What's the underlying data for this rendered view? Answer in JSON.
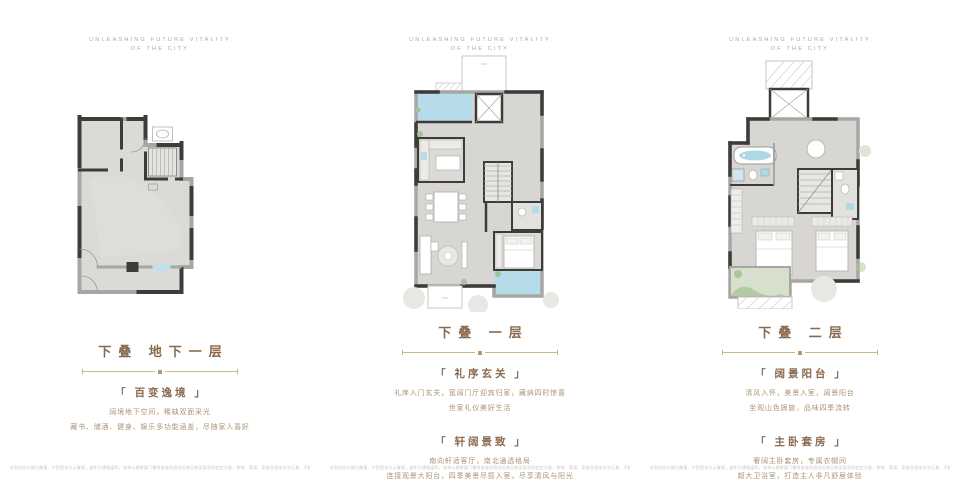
{
  "page": {
    "header_line1": "UNLEASHING FUTURE VITALITY",
    "header_line2": "OF THE CITY",
    "disclaimer": "本资料仅为要约邀请，户型图仅为示意图，面积为建筑面积，具体以政府部门最终批准的图纸及商品房买卖合同约定为准；装修、家具、家电及绿化仅为示意，不属于交付标准。"
  },
  "colors": {
    "accent_brown": "#8a6a4f",
    "body_text": "#ab9373",
    "divider": "#cbb795",
    "floor_fill": "#d8d6d2",
    "wall_dark": "#3d3c3a",
    "wall_light": "#a8a6a3",
    "water_blue": "#b5dce8",
    "plant_green": "#a3c296",
    "tree_gray": "#e9e7e4"
  },
  "panels": [
    {
      "title": "下叠 地下一层",
      "plan_name": "basement-floorplan",
      "sections": [
        {
          "heading": "「 百变逸境 」",
          "lines": [
            "阔境地下空间，稀缺双面采光",
            "藏书、储酒、健身、娱乐多功能涵盖，尽随家人喜好"
          ]
        }
      ]
    },
    {
      "title": "下叠 一层",
      "plan_name": "first-floorplan",
      "sections": [
        {
          "heading": "「 礼序玄关 」",
          "lines": [
            "礼序入门玄关，宽阔门厅迎宾归家，藏纳四时惊喜",
            "世家礼仪美好生活"
          ]
        },
        {
          "heading": "「 轩阔景致 」",
          "lines": [
            "南向轩适客厅，南北通透格局",
            "连接观景大阳台，四季美景尽揽入室，尽享清风与阳光"
          ]
        }
      ]
    },
    {
      "title": "下叠 二层",
      "plan_name": "second-floorplan",
      "sections": [
        {
          "heading": "「 阔景阳台 」",
          "lines": [
            "清风入怀，美景入室，阔景阳台",
            "坐观山色旖旎，品味四季流转"
          ]
        },
        {
          "heading": "「 主卧套房 」",
          "lines": [
            "奢阔主卧套房，专属衣帽间",
            "超大卫浴室，打造主人非凡舒居体验"
          ]
        }
      ]
    }
  ]
}
